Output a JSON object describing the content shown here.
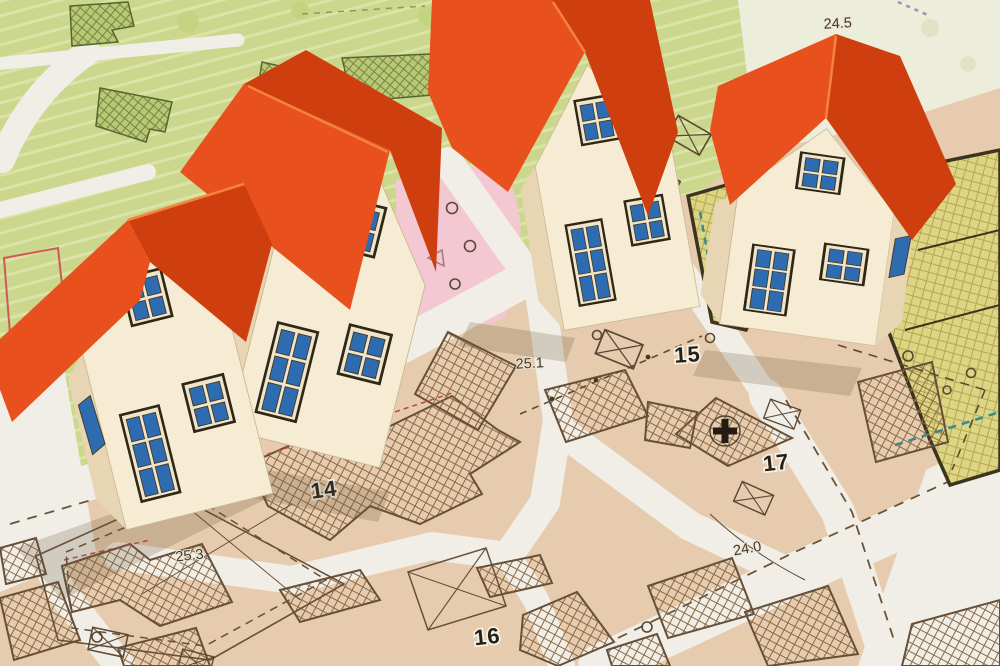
{
  "map_labels": {
    "block_15": "15",
    "block_17": "17",
    "block_14": "14",
    "block_16": "16",
    "elev_24_5": "24.5",
    "elev_25_1": "25.1",
    "elev_25_3": "25.3",
    "elev_24_0": "24.0"
  },
  "palette": {
    "roof_bright": "#e8511d",
    "roof_shaded": "#cf3e0f",
    "roof_edge": "#f4833f",
    "house_wall": "#f6ecd3",
    "house_wall_shade": "#e7d5b4",
    "window_glass": "#2e6cb2",
    "window_frame": "#efe5cb",
    "map_paper_tan": "#e6cbae",
    "map_green": "#cbd78d",
    "map_pale": "#ecedda",
    "map_pink": "#f3c8d3",
    "map_yellow": "#ddd584",
    "road_white": "#f0eee6",
    "parcel_line": "#66503a",
    "red_boundary": "#cc5a55",
    "teal_dash": "#2f8e94",
    "label_dark": "#262015"
  }
}
